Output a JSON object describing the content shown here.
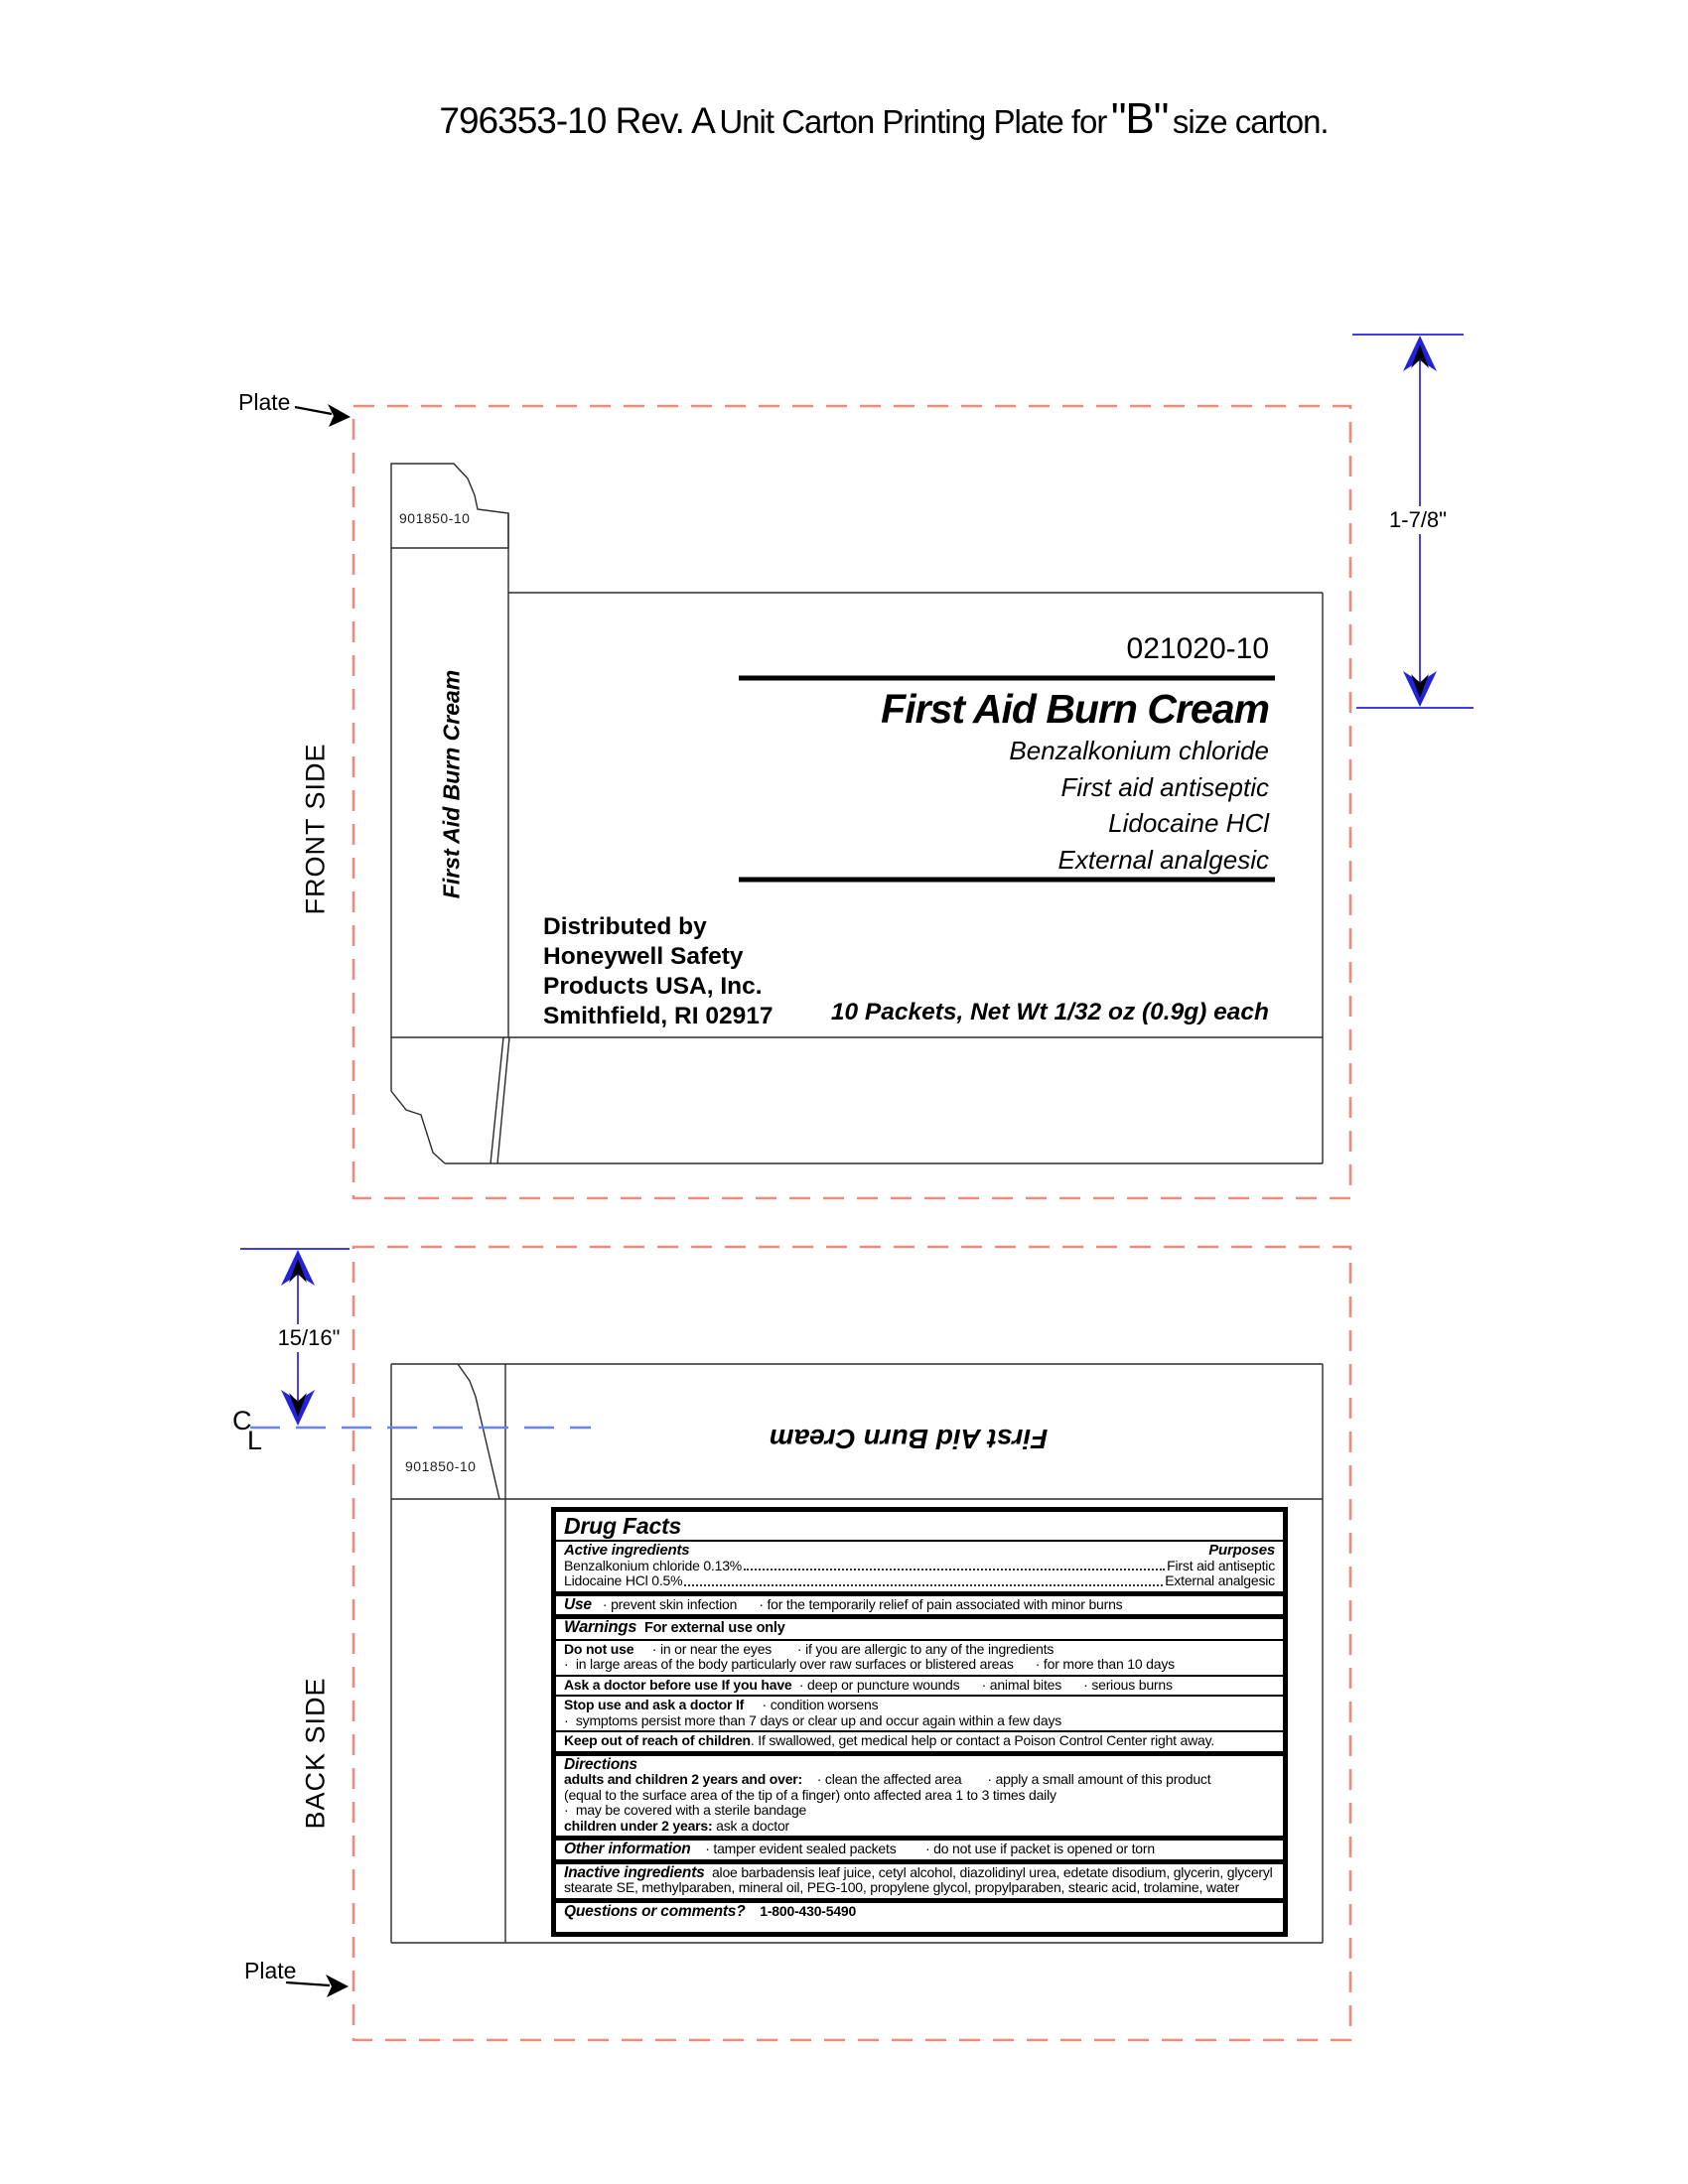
{
  "title": {
    "doc_number": "796353-10 Rev. A",
    "middle": "Unit Carton Printing Plate for",
    "size_code": "\"B\"",
    "suffix": "size carton."
  },
  "annotations": {
    "plate_label_top": "Plate",
    "plate_label_bottom": "Plate",
    "front_side_label": "FRONT SIDE",
    "back_side_label": "BACK SIDE",
    "height_dimension": "1-7/8\"",
    "offset_dimension": "15/16\"",
    "centerline_c": "C",
    "centerline_l": "L"
  },
  "colors": {
    "plate_boundary_dash": "#ee8a7c",
    "dimension_blue": "#2222dd",
    "centerline_blue": "#6b83f0",
    "ink_black": "#000000"
  },
  "front": {
    "flap_code": "901850-10",
    "spine_title": "First Aid Burn Cream",
    "panel_code": "021020-10",
    "product_title": "First Aid Burn Cream",
    "subtitles": [
      "Benzalkonium chloride",
      "First aid antiseptic",
      "Lidocaine HCl",
      "External analgesic"
    ],
    "distributor_lines": [
      "Distributed by",
      "Honeywell Safety",
      "Products USA, Inc.",
      "Smithfield, RI 02917"
    ],
    "net_contents": "10 Packets, Net Wt 1/32 oz (0.9g) each"
  },
  "back": {
    "flap_code": "901850-10",
    "panel_title": "First Aid Burn Cream",
    "drug_facts": {
      "title": "Drug Facts",
      "active_header": "Active ingredients",
      "purposes_header": "Purposes",
      "actives": [
        {
          "name": "Benzalkonium chloride 0.13%",
          "purpose": "First aid antiseptic"
        },
        {
          "name": "Lidocaine HCl 0.5%",
          "purpose": "External analgesic"
        }
      ],
      "use_label": "Use",
      "use_text": "   · prevent skin infection      · for the temporarily relief of pain associated with minor burns",
      "warnings_label": "Warnings",
      "warnings_note": "  For external use only",
      "do_not_use_label": "Do not use",
      "do_not_use_text": "     · in or near the eyes       · if you are allergic to any of the ingredients",
      "do_not_use_line2": "·  in large areas of the body particularly over raw surfaces or blistered areas      · for more than 10 days",
      "ask_doctor_label": "Ask a doctor before use If you have",
      "ask_doctor_text": "  · deep or puncture wounds      · animal bites      · serious burns",
      "stop_use_label": "Stop use and ask a doctor If",
      "stop_use_text": "     · condition worsens",
      "stop_use_line2": "·  symptoms persist more than 7 days or clear up and occur again within a few days",
      "keep_out_label": "Keep out of reach of children",
      "keep_out_text": ". If swallowed, get medical help or contact a Poison Control Center right away.",
      "directions_label": "Directions",
      "directions_line1_label": "adults and children 2 years and over:",
      "directions_line1_text": "    · clean the affected area       · apply a small amount of this product",
      "directions_line2": "(equal to the surface area of the tip of a finger) onto affected area 1 to 3 times daily",
      "directions_line3": "·  may be covered with a sterile bandage",
      "directions_line4_label": "children under 2 years:",
      "directions_line4_text": " ask a doctor",
      "other_info_label": "Other information",
      "other_info_text": "    · tamper evident sealed packets        · do not use if packet is opened or torn",
      "inactive_label": "Inactive ingredients",
      "inactive_text": "  aloe barbadensis leaf juice, cetyl alcohol, diazolidinyl urea, edetate disodium, glycerin, glyceryl stearate SE, methylparaben, mineral oil, PEG-100, propylene glycol, propylparaben, stearic acid, trolamine, water",
      "questions_label": "Questions or comments?",
      "questions_text": "    1-800-430-5490"
    }
  }
}
